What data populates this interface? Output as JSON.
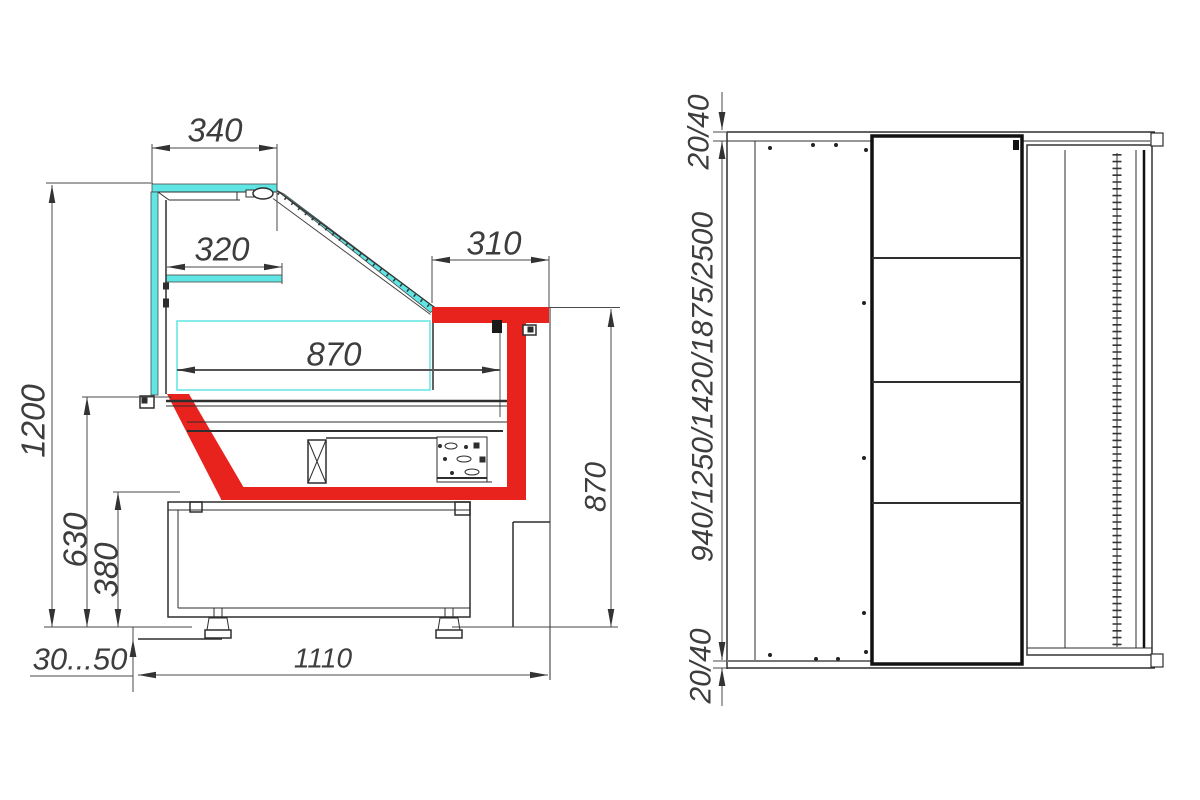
{
  "side_view": {
    "dims": {
      "canopy_width": "340",
      "shelf_depth": "320",
      "counter_top_depth": "310",
      "display_depth": "870",
      "overall_height": "1200",
      "deck_height": "630",
      "base_height": "380",
      "counter_height": "870",
      "foot_adjust_range": "30...50",
      "base_depth": "1110"
    }
  },
  "top_view": {
    "dims": {
      "rear_gap_top": "20/40",
      "length_options": "940/1250/1420/1875/2500",
      "rear_gap_bottom": "20/40"
    }
  },
  "colors": {
    "glass_cyan": "#5FE6E4",
    "counter_red": "#E8231E",
    "outline_dark": "#2E2E2E",
    "dim_line": "#4A4A4A",
    "background": "#FFFFFF"
  }
}
